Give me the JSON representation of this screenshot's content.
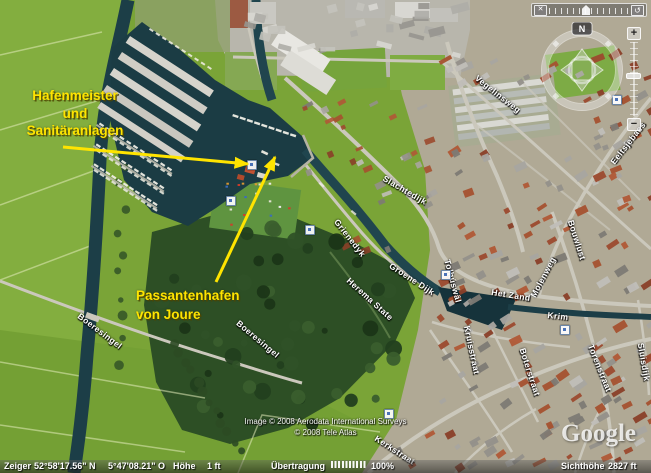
{
  "colors": {
    "annotation_yellow": "#ffe400",
    "water": "#1c3e47",
    "field_green": "#7aa437",
    "status_text": "#ffffff"
  },
  "annotations": {
    "label_hafenmeister": "Hafenmeister\nund\nSanitäranlagen",
    "label_passantenhafen": "Passantenhafen\nvon Joure"
  },
  "map": {
    "copyright_line1": "Image © 2008 Aerodata International Surveys",
    "copyright_line2": "© 2008 Tele Atlas",
    "logo": "Google",
    "street_labels": [
      {
        "text": "Slachtedijk",
        "x": 405,
        "y": 190,
        "rot": 30
      },
      {
        "text": "Grienedyk",
        "x": 350,
        "y": 238,
        "rot": 52
      },
      {
        "text": "Groene Dijk",
        "x": 412,
        "y": 279,
        "rot": 33
      },
      {
        "text": "Vegelinsweg",
        "x": 498,
        "y": 94,
        "rot": 38
      },
      {
        "text": "Eeltsjebaes",
        "x": 628,
        "y": 143,
        "rot": -52
      },
      {
        "text": "Bouwlust",
        "x": 577,
        "y": 240,
        "rot": 72
      },
      {
        "text": "Het Zand",
        "x": 511,
        "y": 295,
        "rot": 9
      },
      {
        "text": "Molenweg",
        "x": 543,
        "y": 277,
        "rot": -62
      },
      {
        "text": "Krim",
        "x": 558,
        "y": 316,
        "rot": 6
      },
      {
        "text": "Sluisdijk",
        "x": 644,
        "y": 362,
        "rot": 80
      },
      {
        "text": "Boterstraat",
        "x": 530,
        "y": 372,
        "rot": 72
      },
      {
        "text": "Kruisstraat",
        "x": 472,
        "y": 350,
        "rot": 78
      },
      {
        "text": "Torenstraat",
        "x": 600,
        "y": 368,
        "rot": 68
      },
      {
        "text": "Kerkstraat",
        "x": 395,
        "y": 450,
        "rot": 33
      },
      {
        "text": "Boeresingel",
        "x": 100,
        "y": 331,
        "rot": 37
      },
      {
        "text": "Boeresingel",
        "x": 258,
        "y": 339,
        "rot": 40
      },
      {
        "text": "Herema State",
        "x": 370,
        "y": 299,
        "rot": 42
      },
      {
        "text": "Tolhúswâl",
        "x": 453,
        "y": 281,
        "rot": 75
      }
    ],
    "placemarks": [
      {
        "x": 226,
        "y": 196
      },
      {
        "x": 247,
        "y": 160
      },
      {
        "x": 384,
        "y": 409
      },
      {
        "x": 441,
        "y": 270
      },
      {
        "x": 560,
        "y": 325
      },
      {
        "x": 612,
        "y": 95
      },
      {
        "x": 305,
        "y": 225
      }
    ]
  },
  "status_bar": {
    "pointer_label": "Zeiger",
    "latitude": "52°58'17.56\" N",
    "longitude": "5°47'08.21\" O",
    "elevation_label": "Höhe",
    "elevation_value": "1 ft",
    "streaming_label": "Übertragung",
    "streaming_percent": "100%",
    "eye_alt_label": "Sichthöhe",
    "eye_alt_value": "2827 ft"
  },
  "nav": {
    "north_label": "N",
    "zoom_in": "+",
    "zoom_out": "−",
    "close_glyph": "✕",
    "history_glyph": "↺"
  }
}
